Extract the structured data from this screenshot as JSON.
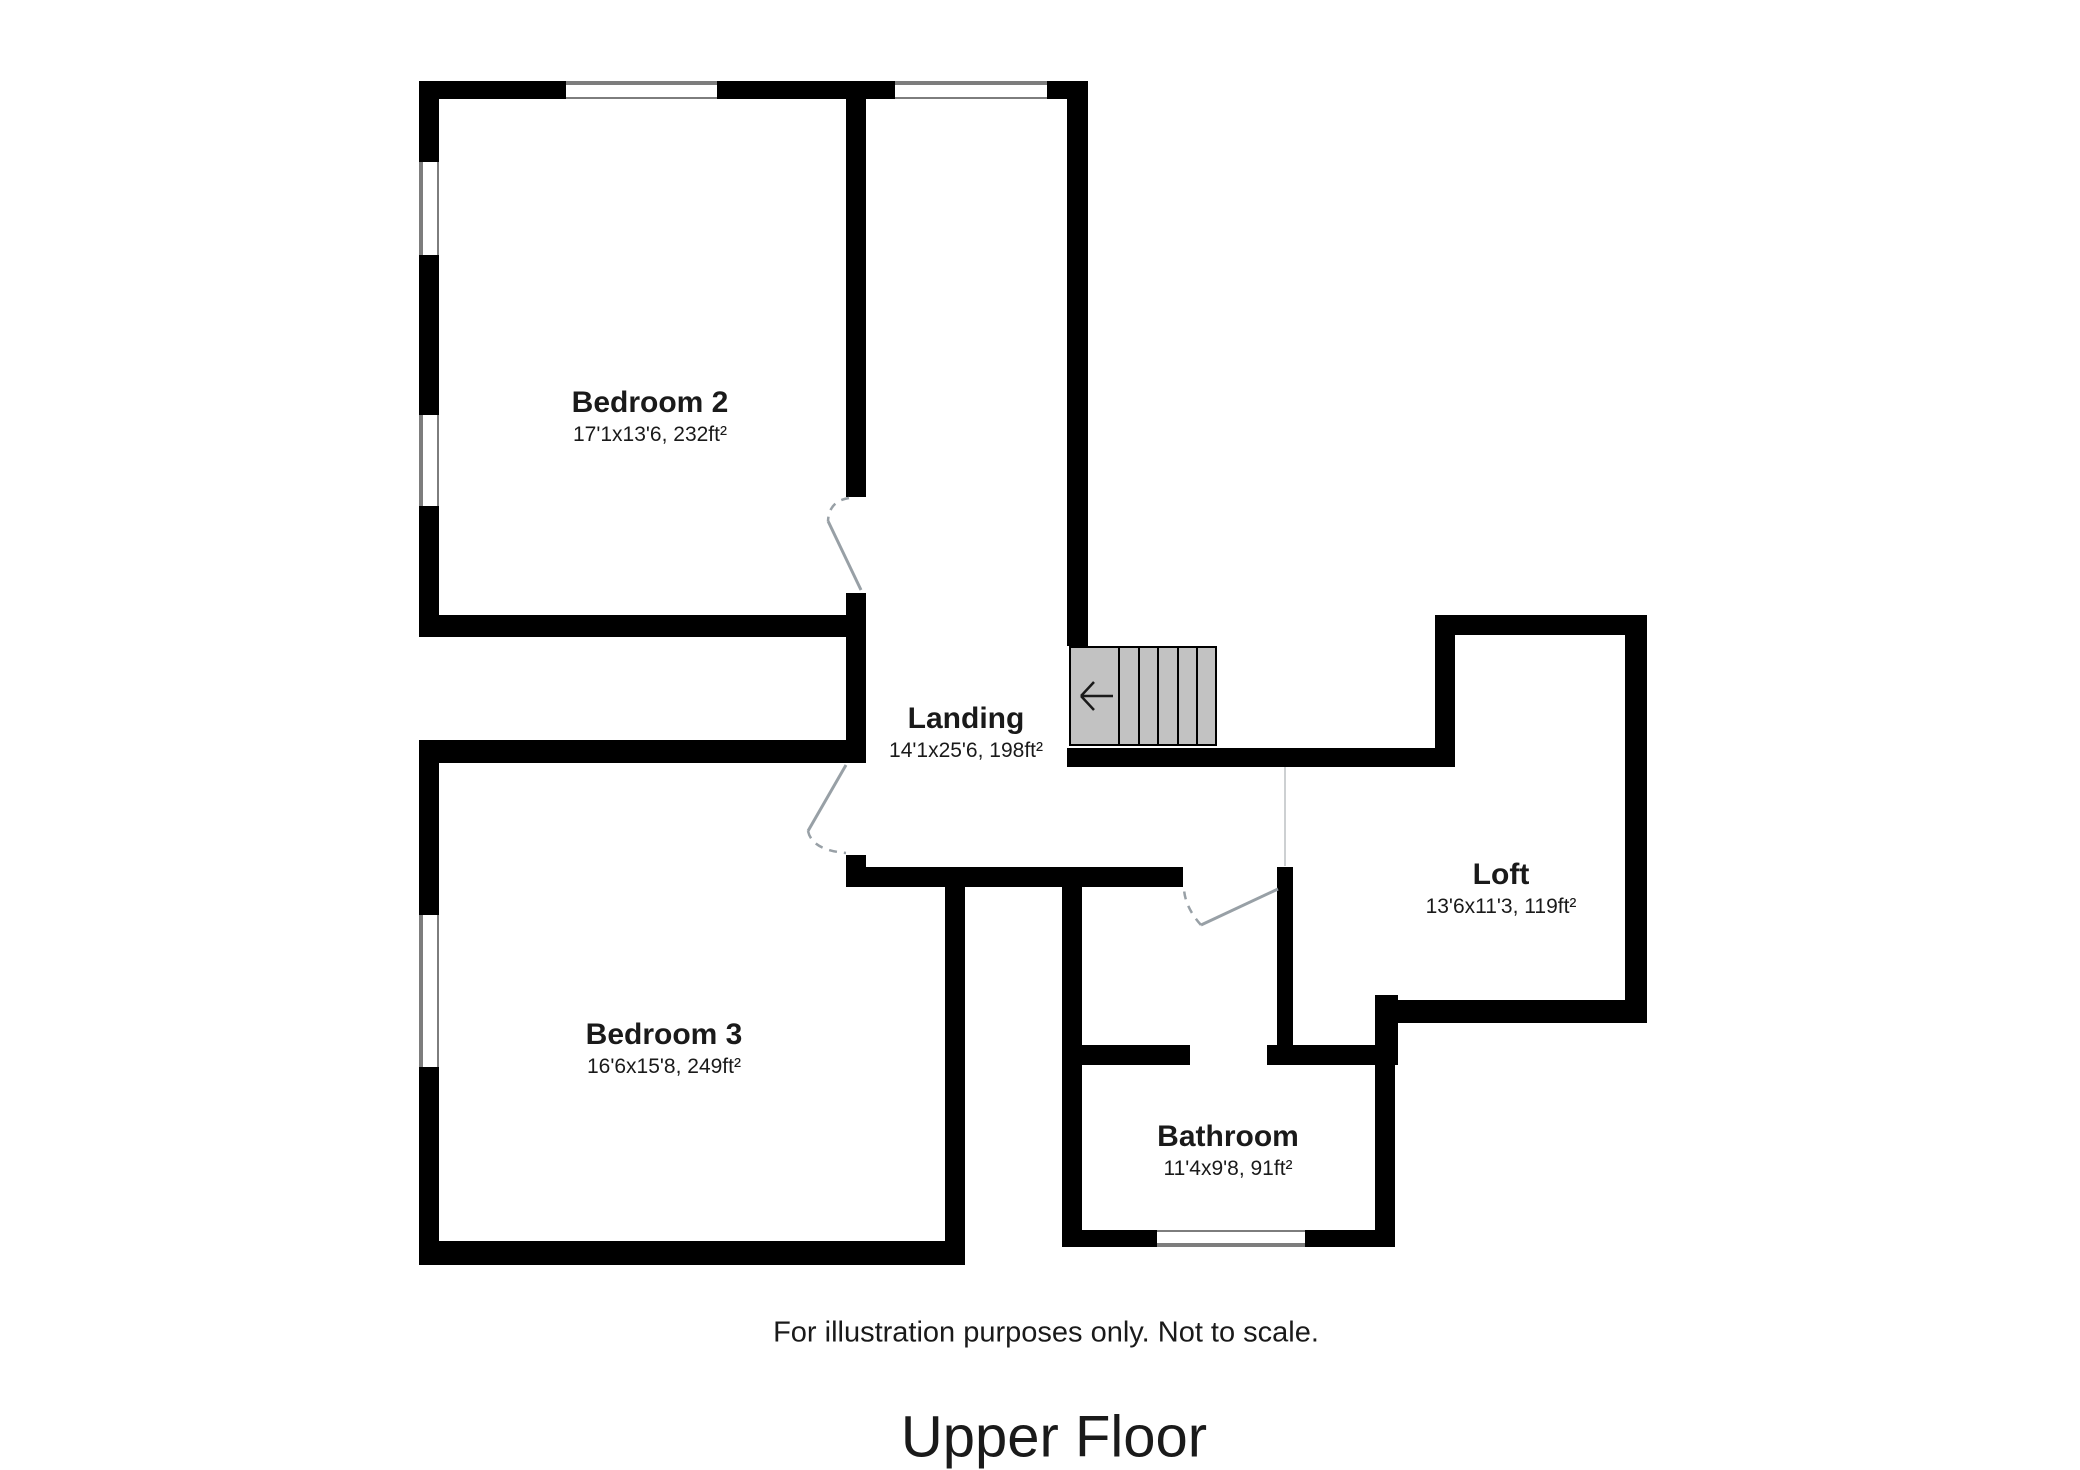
{
  "title": "Upper Floor",
  "disclaimer": "For illustration purposes only. Not to scale.",
  "rooms": {
    "bedroom2": {
      "name": "Bedroom 2",
      "dims": "17'1x13'6, 232ft²"
    },
    "bedroom3": {
      "name": "Bedroom 3",
      "dims": "16'6x15'8, 249ft²"
    },
    "landing": {
      "name": "Landing",
      "dims": "14'1x25'6, 198ft²"
    },
    "loft": {
      "name": "Loft",
      "dims": "13'6x11'3, 119ft²"
    },
    "bathroom": {
      "name": "Bathroom",
      "dims": "11'4x9'8, 91ft²"
    }
  },
  "stairs": {
    "direction_icon": "left-arrow",
    "tread_count": 5
  },
  "colors": {
    "wall": "#000000",
    "stair_fill": "#c2c2c2",
    "door": "#98a0a6",
    "divider": "#cdd0d2",
    "window_frame": "#7d7d7d"
  }
}
